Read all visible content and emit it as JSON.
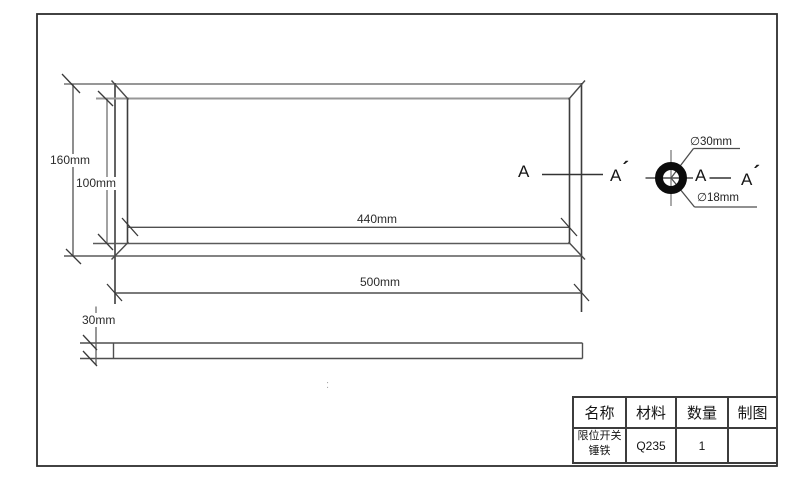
{
  "page": {
    "background": "#ffffff",
    "line_color": "#555555",
    "light_line_color": "#979797",
    "ring_color": "#0c0c0c",
    "frame_color": "#2e2e2e"
  },
  "dimensions": {
    "outer_height": "160mm",
    "inner_height": "100mm",
    "inner_width": "440mm",
    "outer_width": "500mm",
    "plate_thickness": "30mm",
    "outer_diameter": "∅30mm",
    "inner_diameter": "∅18mm"
  },
  "section_view": {
    "label_a": "A",
    "prime_mark": "´"
  },
  "stray_mark": ":",
  "title_block": {
    "headers": [
      "名称",
      "材料",
      "数量",
      "制图"
    ],
    "row": {
      "name_line1": "限位开关",
      "name_line2": "锤铁",
      "material": "Q235",
      "quantity": "1",
      "drafting": ""
    }
  }
}
